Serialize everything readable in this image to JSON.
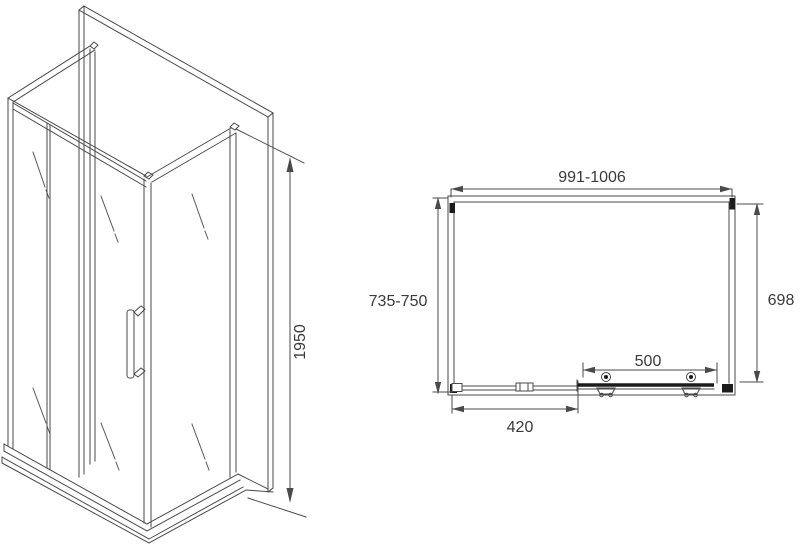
{
  "side_view": {
    "height_label": "1950"
  },
  "plan_view": {
    "width_label": "991-1006",
    "depth_left_label": "735-750",
    "depth_right_label": "698",
    "door_label": "500",
    "panel_label": "420"
  },
  "colors": {
    "line": "#4a4a4a",
    "dark": "#1c1c1c",
    "text": "#3a3a3a",
    "background": "#ffffff"
  }
}
